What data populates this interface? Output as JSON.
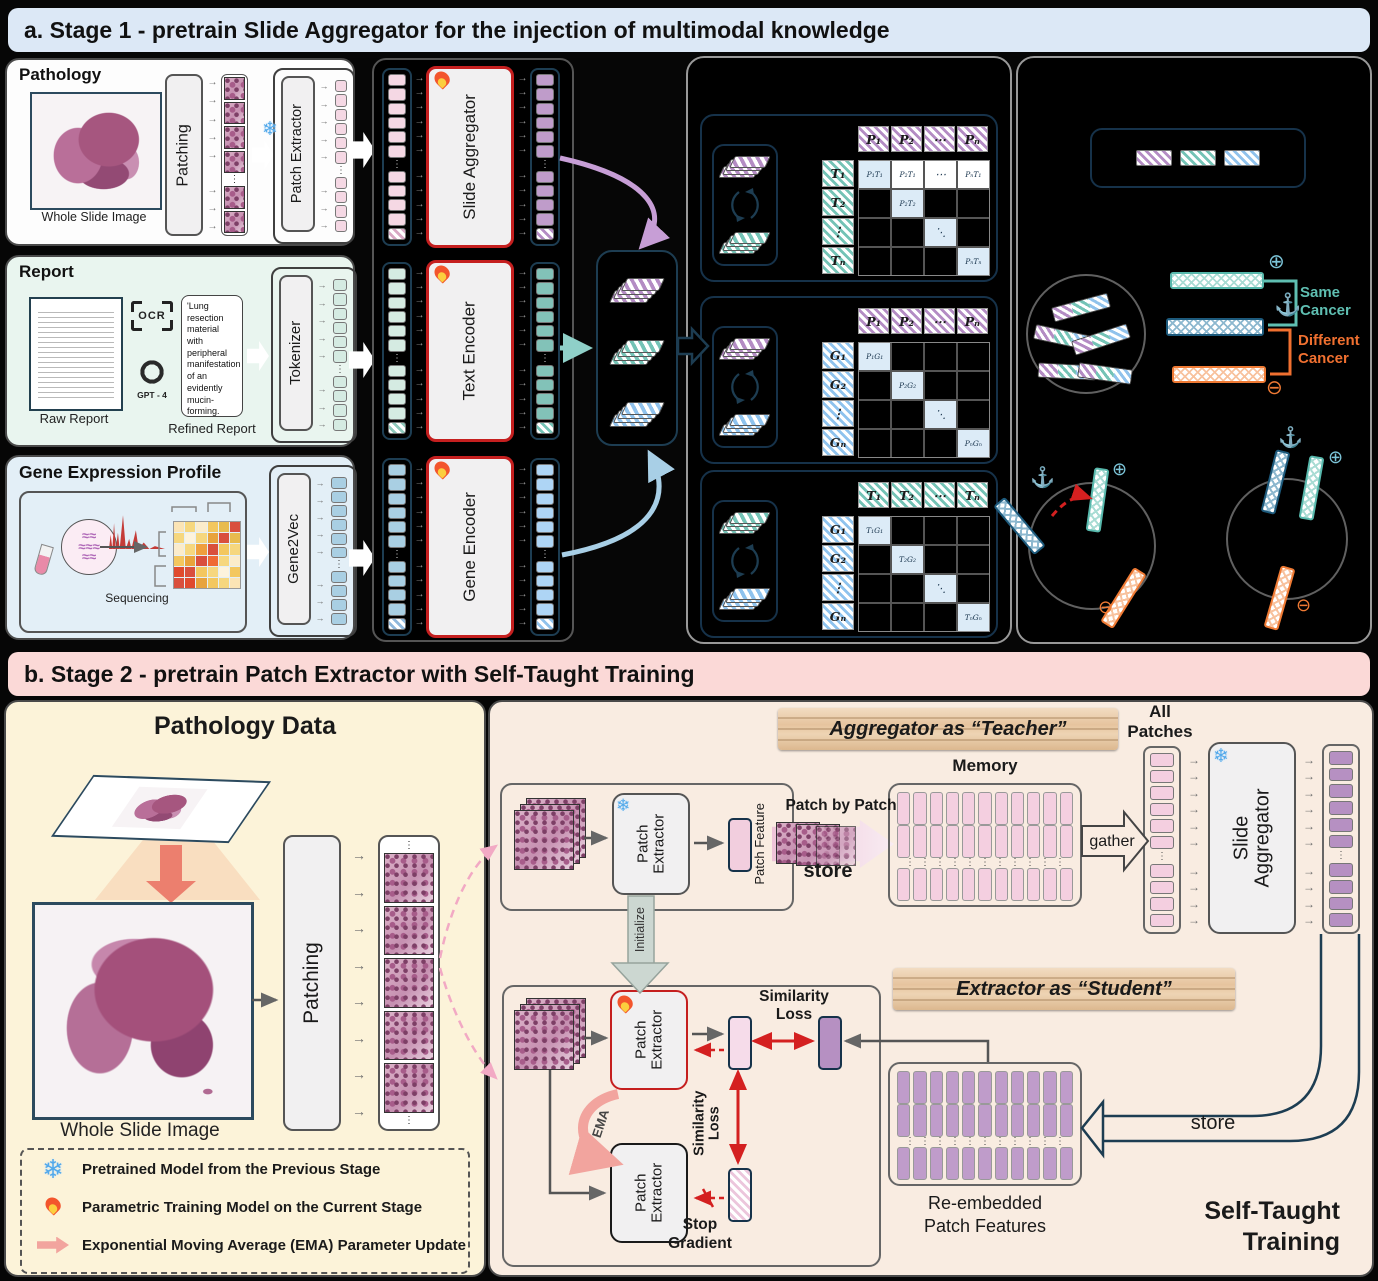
{
  "colors": {
    "stage1_banner_bg": "#dce8f6",
    "stage2_banner_bg": "#fbd9d7",
    "same_cancer": "#5fbfb2",
    "different_cancer": "#f07030",
    "trainable_border": "#c51f1f",
    "pink_token": "#f5d8e4",
    "purple_token": "#bf9cca",
    "teal_token": "#82c2b8",
    "blue_token": "#a9cfe3"
  },
  "stage1": {
    "banner": "a. Stage 1 - pretrain Slide Aggregator for the injection of multimodal knowledge",
    "pathology": {
      "title": "Pathology",
      "caption": "Whole Slide Image",
      "patching": "Patching",
      "patch_extractor": "Patch Extractor"
    },
    "report": {
      "title": "Report",
      "raw_caption": "Raw Report",
      "ocr_label": "OCR",
      "gpt_label": "GPT - 4",
      "refined_text": "'Lung resection material with peripheral manifestation of an evidently mucin-forming.",
      "refined_caption": "Refined Report",
      "tokenizer": "Tokenizer"
    },
    "gene": {
      "title": "Gene Expression Profile",
      "sequencing": "Sequencing",
      "gene2vec": "Gene2Vec"
    },
    "encoders": {
      "slide": "Slide Aggregator",
      "text": "Text Encoder",
      "gene": "Gene Encoder"
    },
    "matrices": [
      {
        "col_head": [
          "P₁",
          "P₂",
          "⋯",
          "Pₙ"
        ],
        "row_head": [
          "T₁",
          "T₂",
          "⋮",
          "Tₙ"
        ],
        "grid": [
          [
            "P₁T₁",
            "P₂T₁",
            "⋯",
            "PₙT₁"
          ],
          [
            "",
            "P₂T₂",
            "",
            ""
          ],
          [
            "",
            "",
            "⋱",
            ""
          ],
          [
            "",
            "",
            "",
            "PₙTₙ"
          ]
        ],
        "col_color": "purple",
        "row_color": "teal",
        "first_row_filled": true
      },
      {
        "col_head": [
          "P₁",
          "P₂",
          "⋯",
          "Pₙ"
        ],
        "row_head": [
          "G₁",
          "G₂",
          "⋮",
          "Gₙ"
        ],
        "grid": [
          [
            "P₁G₁",
            "",
            "",
            ""
          ],
          [
            "",
            "P₂G₂",
            "",
            ""
          ],
          [
            "",
            "",
            "⋱",
            ""
          ],
          [
            "",
            "",
            "",
            "PₙGₙ"
          ]
        ],
        "col_color": "purple",
        "row_color": "blue",
        "first_row_filled": false
      },
      {
        "col_head": [
          "T₁",
          "T₂",
          "⋯",
          "Tₙ"
        ],
        "row_head": [
          "G₁",
          "G₂",
          "⋮",
          "Gₙ"
        ],
        "grid": [
          [
            "T₁G₁",
            "",
            "",
            ""
          ],
          [
            "",
            "T₂G₂",
            "",
            ""
          ],
          [
            "",
            "",
            "⋱",
            ""
          ],
          [
            "",
            "",
            "",
            "TₙGₙ"
          ]
        ],
        "col_color": "teal",
        "row_color": "blue",
        "first_row_filled": false
      }
    ],
    "alignment": {
      "same": "Same Cancer",
      "different": "Different Cancer"
    }
  },
  "stage2": {
    "banner": "b. Stage 2 - pretrain Patch Extractor with Self-Taught Training",
    "pathology_data": {
      "title": "Pathology Data",
      "wsi_caption": "Whole Slide Image",
      "patching": "Patching"
    },
    "legend": {
      "items": [
        {
          "icon": "snowflake-icon",
          "label": "Pretrained Model from the Previous Stage"
        },
        {
          "icon": "fire-icon",
          "label": "Parametric Training Model on the Current Stage"
        },
        {
          "icon": "ema-arrow-icon",
          "label": "Exponential Moving Average (EMA) Parameter Update"
        }
      ]
    },
    "teacher": {
      "banner": "Aggregator as “Teacher”",
      "all_patches": "All Patches",
      "memory": "Memory",
      "patch_extractor": "Patch Extractor",
      "patch_feature": "Patch Feature",
      "patch_by_patch": "Patch by Patch",
      "store": "store",
      "gather": "gather",
      "slide_aggregator": "Slide Aggregator"
    },
    "initialize": "Initialize",
    "student": {
      "banner": "Extractor as “Student”",
      "patch_extractor_top": "Patch Extractor",
      "patch_extractor_bottom": "Patch Extractor",
      "similarity_loss_h": "Similarity Loss",
      "similarity_loss_v": "Similarity Loss",
      "ema": "EMA",
      "stop_gradient": "Stop Gradient",
      "reembedded": "Re-embedded Patch Features",
      "store": "store",
      "self_taught": "Self-Taught Training"
    }
  }
}
